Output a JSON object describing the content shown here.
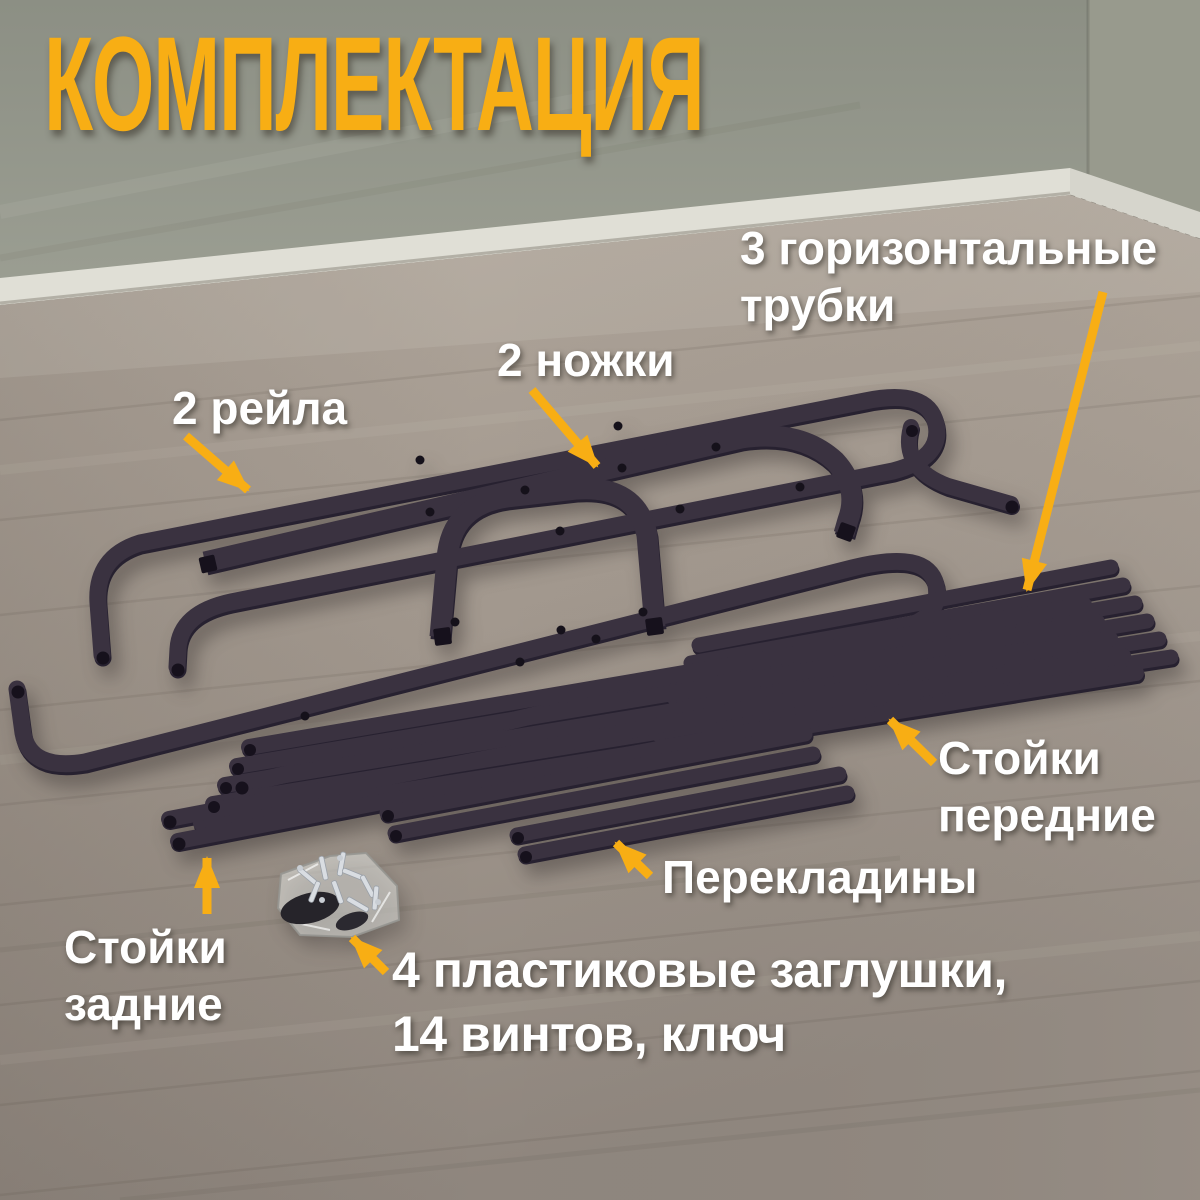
{
  "title": "КОМПЛЕКТАЦИЯ",
  "labels": {
    "horizontal_tubes": "3 горизонтальные\nтрубки",
    "legs": "2 ножки",
    "rails": "2 рейла",
    "front_stands": "Стойки\nпередние",
    "crossbars": "Перекладины",
    "rear_stands": "Стойки\nзадние",
    "hardware": "4 пластиковые заглушки,\n14 винтов, ключ"
  },
  "colors": {
    "accent": "#F8AE14",
    "label_text": "#FFFFFF",
    "metal_dark": "#272130",
    "metal_light": "#3A3240",
    "wall": "#8F9186",
    "wall_right": "#989A8D",
    "baseboard": "#E0DFD6",
    "floor_light": "#B3A99E",
    "floor_dark": "#948B83"
  },
  "icons": [
    {
      "name": "arrow-pointer",
      "meaning": "yellow annotation arrow linking label to part",
      "count": 7
    }
  ]
}
